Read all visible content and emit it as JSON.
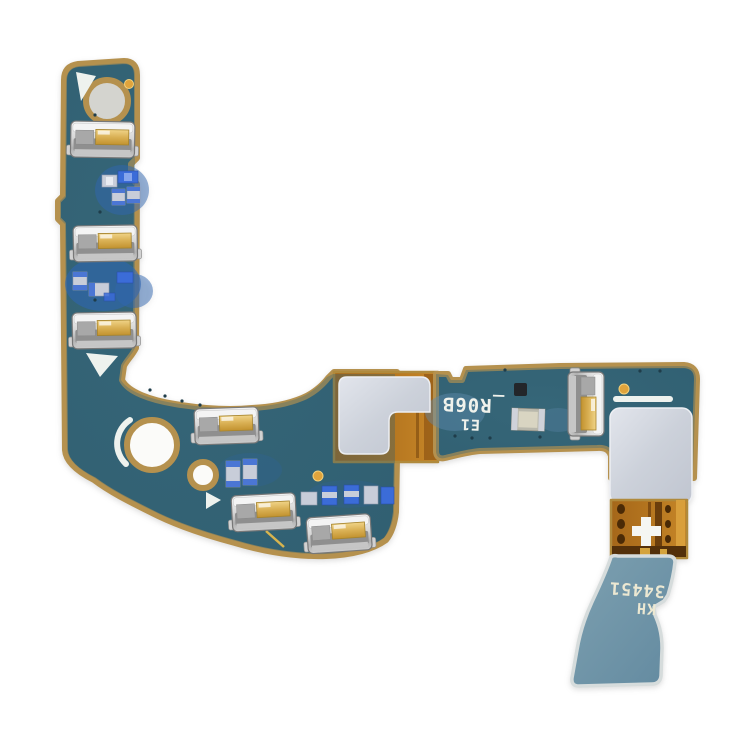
{
  "image": {
    "type": "product-photo",
    "subject": "phone signal antenna flex cable board (PCB with spring contacts)",
    "background_color": "#ffffff"
  },
  "silkscreen": {
    "board_marking_line1": "_R06B",
    "board_marking_line2": "E1",
    "tail_marking_line1": "34451",
    "tail_marking_line2": "KH",
    "note": "markings are printed rotated 180 degrees on the board"
  },
  "colors": {
    "board_teal": "#336274",
    "board_edge_tan": "#b5914e",
    "kapton_orange": "#b4751f",
    "kapton_dark": "#53300a",
    "kapton_highlight": "#dca23e",
    "sticker_gray": "#ced3dc",
    "tail_blue_gray": "#6d93a5",
    "metal_silver": "#d6d6d6",
    "contact_gold": "#d9b054",
    "component_blue": "#3b6cd8",
    "coating_blue": "#2f66b0",
    "silkscreen_white": "#eef2ee",
    "fiducial_gold": "#e0a43c"
  }
}
